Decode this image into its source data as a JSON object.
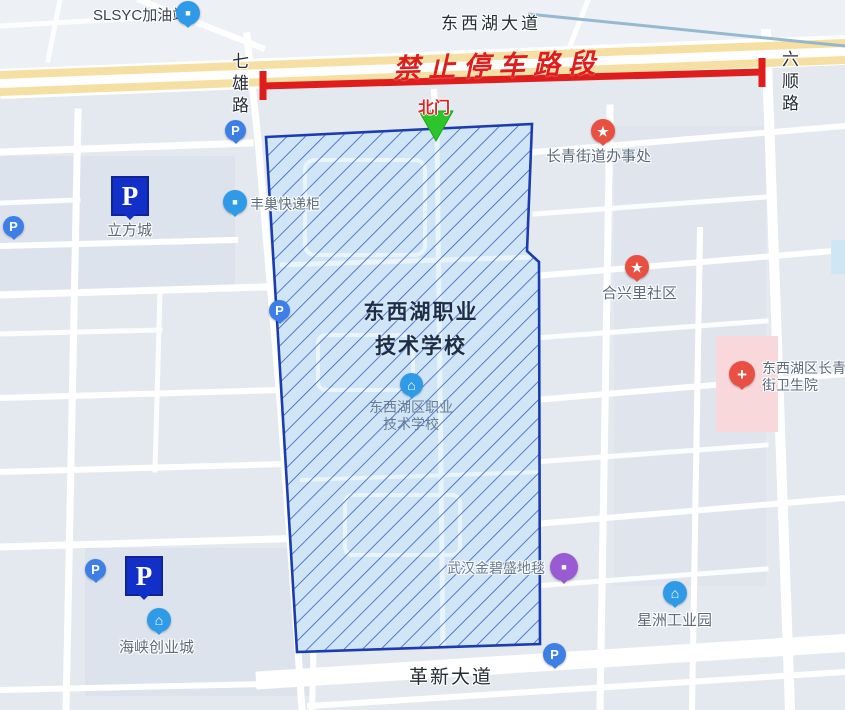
{
  "roads": {
    "dongxihu_avenue": "东西湖大道",
    "qixiong_road": "七雄路",
    "liushun_road": "六顺路",
    "gexin_avenue": "革新大道"
  },
  "overlay": {
    "no_parking_text": "禁止停车路段",
    "north_gate": "北门"
  },
  "school": {
    "title_line1": "东西湖职业",
    "title_line2": "技术学校",
    "poi_line1": "东西湖区职业",
    "poi_line2": "技术学校"
  },
  "pois": {
    "slsyc": {
      "label": "SLSYC加油站"
    },
    "lifang": {
      "label": "立方城"
    },
    "fengchao": {
      "label": "丰巢快递柜"
    },
    "changqing": {
      "label": "长青街道办事处"
    },
    "hexingli": {
      "label": "合兴里社区"
    },
    "hospital": {
      "label_line1": "东西湖区长青",
      "label_line2": "街卫生院"
    },
    "carpet": {
      "label": "武汉金碧盛地毯"
    },
    "xingzhou": {
      "label": "星洲工业园"
    },
    "haixia": {
      "label": "海峡创业城"
    }
  },
  "glyphs": {
    "parking": "P",
    "star": "★",
    "cross": "+",
    "house": "⌂",
    "square": "■"
  },
  "colors": {
    "restricted_red": "#e01d1d",
    "zone_fill": "#d0e6f7",
    "zone_border": "#1b3cb0",
    "gate_green": "#2cc52c",
    "parking_navy": "#1230c8",
    "poi_red": "#e85043",
    "poi_sky": "#2f9be8",
    "poi_purple": "#9a5bd2",
    "avenue_yellow": "#f6dfa2",
    "hospital_pink": "#f8d8da"
  }
}
